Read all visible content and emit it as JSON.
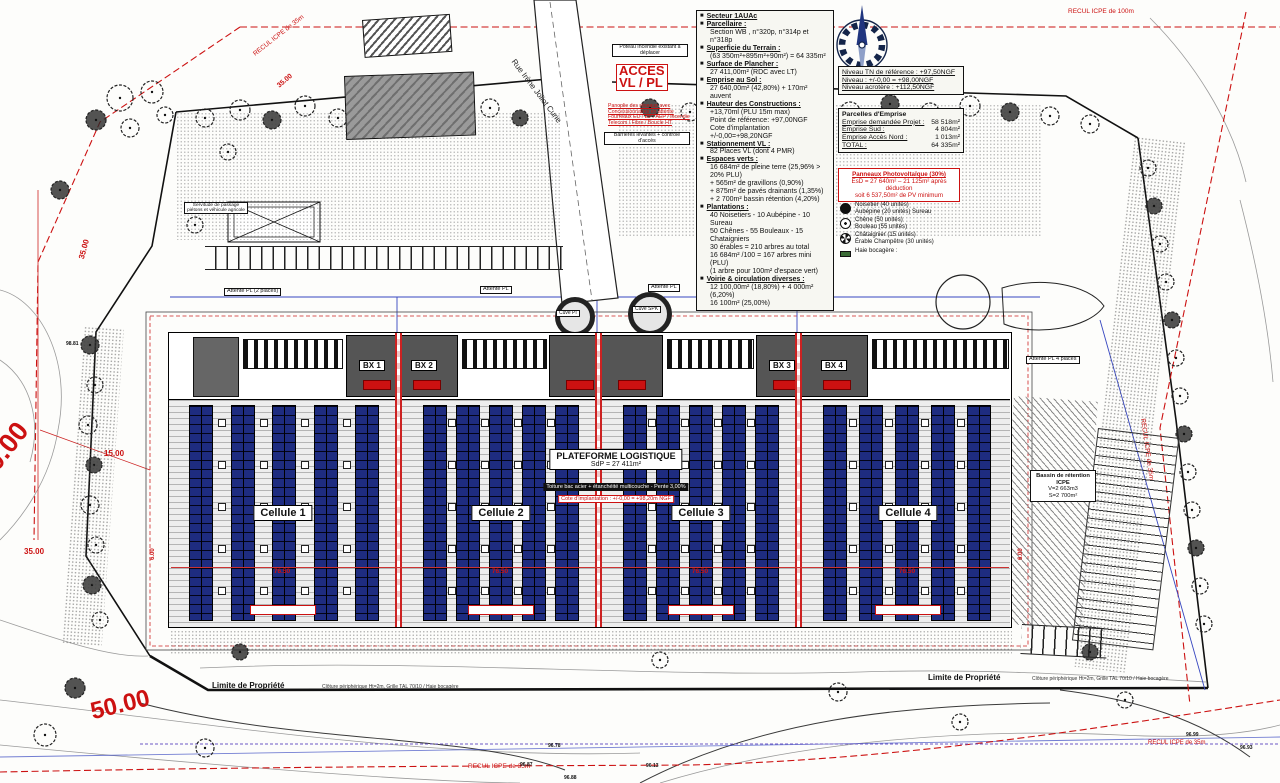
{
  "colors": {
    "annotation_red": "#cc1111",
    "panel_blue": "#1e2c80"
  },
  "legend": {
    "items": [
      {
        "label": "Secteur 1AUAc",
        "lines": []
      },
      {
        "label": "Parcellaire :",
        "lines": [
          "Section WB , n°320p, n°314p et n°318p"
        ]
      },
      {
        "label": "Superficie du Terrain :",
        "lines": [
          "(63 350m²+895m²+90m²) = 64 335m²"
        ]
      },
      {
        "label": "Surface de Plancher :",
        "lines": [
          "27 411,00m² (RDC avec LT)"
        ]
      },
      {
        "label": "Emprise au Sol :",
        "lines": [
          "27 640,00m² (42,80%) + 170m² auvent"
        ]
      },
      {
        "label": "Hauteur des Constructions :",
        "lines": [
          "+13,70ml (PLU 15m max)",
          "Point de référence: +97,00NGF",
          "Cote d'implantation +/-0,00=+98,20NGF"
        ]
      },
      {
        "label": "Stationnement VL :",
        "lines": [
          "82 Places VL (dont 4 PMR)"
        ]
      },
      {
        "label": "Espaces verts :",
        "lines": [
          "16 684m² de pleine terre (25,96% > 20% PLU)",
          "+ 565m² de gravillons (0,90%)",
          "+ 875m² de pavés drainants (1,35%)",
          "+ 2 700m² bassin rétention (4,20%)"
        ]
      },
      {
        "label": "Plantations :",
        "lines": [
          "40 Noisetiers - 10 Aubépine - 10 Sureau",
          "50 Chênes - 55 Bouleaux - 15 Chataigniers",
          "30 érables = 210 arbres au total",
          "16 684m² /100 = 167 arbres mini (PLU)",
          "(1 arbre pour 100m² d'espace vert)"
        ]
      },
      {
        "label": "Voirie & circulation diverses :",
        "lines": [
          "12 100,00m² (18,80%) + 4 000m² (6,20%)",
          "16 100m² (25,00%)"
        ]
      }
    ]
  },
  "levels": {
    "l1": "Niveau TN de référence : +97,50NGF",
    "l2": "Niveau : +/-0,00 = +98,00NGF",
    "l3": "Niveau acrotère : +112,50NGF"
  },
  "emprise": {
    "title": "Parcelles d'Emprise",
    "rows": [
      {
        "label": "Emprise demandée Projet :",
        "value": "58 518m²"
      },
      {
        "label": "Emprise Sud :",
        "value": "4 804m²"
      },
      {
        "label": "Emprise Accès Nord :",
        "value": "1 013m²"
      },
      {
        "label": "TOTAL :",
        "value": "64 335m²"
      }
    ]
  },
  "pv": {
    "l1": "Panneaux Photovoltaïque (30%)",
    "l2": "EsD = 27 640m² – 21 125m² après déduction",
    "l3": "soit 6 537,50m² de PV minimum"
  },
  "plants": {
    "items": [
      {
        "name": "Noisetier (40 unités)",
        "name2": "Aubépine (20 unités) Sureau"
      },
      {
        "name": "Chêne (50 unités)",
        "name2": "Bouleau (55 unités)"
      },
      {
        "name": "Châtaignier (15 unités)",
        "name2": "Érable Champêtre (30 unités)"
      },
      {
        "name": "Haie bocagère :",
        "name2": ""
      }
    ]
  },
  "building": {
    "platform_title": "PLATEFORME LOGISTIQUE",
    "platform_sub": "SdP = 27 411m²",
    "roof_note": "Toiture bac acier + étanchéité multicouche - Pente 3,00%",
    "cote_note": "Cote d'implantation : +/-0,00 = +98,20m NGF",
    "cells": [
      "Cellule 1",
      "Cellule 2",
      "Cellule 3",
      "Cellule 4"
    ],
    "bx": [
      "BX 1",
      "BX 2",
      "BX 3",
      "BX 4"
    ],
    "cuves": [
      "Cuve PI",
      "Cuve SPK"
    ]
  },
  "basin": {
    "l1": "Bassin de rétention ICPE",
    "l2": "V=2 663m3",
    "l3": "S=2 700m²"
  },
  "annotations": {
    "acces_l1": "ACCES",
    "acces_l2": "VL / PL",
    "poteau": "Poteau Incendie existant à déplacer",
    "barrieres": "Barrières levantes + contrôle d'accès",
    "reseaux": [
      "Panoplie des réseaux avec",
      "Concessionnaires en attente",
      "Fourreaux EU / EP / AEP / Incendie",
      "Telecom / Fibre / Boucle HT"
    ],
    "attente_pl_2": "Attente PL (2 places)",
    "attente_pl": "Attente PL",
    "attente_pl_4": "Attente PL 4 places",
    "servitude": "Servitude de passage piétons et véhicule agricole"
  },
  "street": {
    "name": "Rue Irène Joliot Curie"
  },
  "recul": {
    "r100": "RECUL ICPE de 100m",
    "r35": "RECUL ICPE de 35m"
  },
  "limite": {
    "label": "Limite de Propriété",
    "fence": "Clôture périphérique Ht=2m, Grille TAL 70/10 / Haie bocagère"
  },
  "dims": {
    "d35": "35.00",
    "d15": "15.00",
    "d50": "50.00",
    "d6": "6.00",
    "d76": "76.50"
  },
  "spots": [
    "96.78",
    "96.87",
    "96.13",
    "96.88",
    "96.99",
    "96.93",
    "98.81"
  ]
}
